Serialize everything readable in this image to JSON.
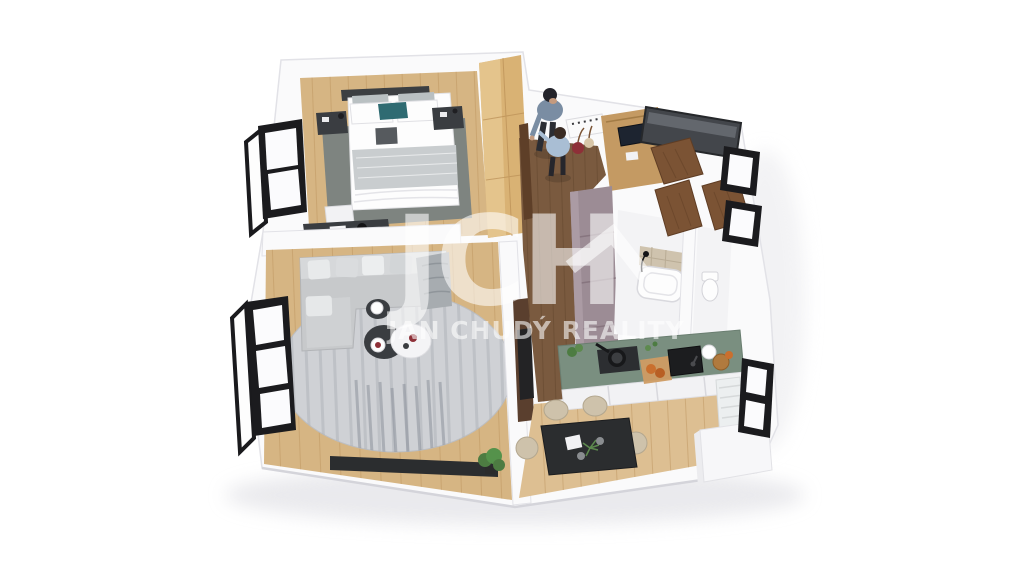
{
  "watermark": {
    "logo": "JCH",
    "roof_icon": "roof-caret",
    "subtitle": "JAN CHUDÝ REALITY"
  },
  "colors": {
    "wall": "#fafafb",
    "wall_edge": "#e2e2e7",
    "wood": "#d6b583",
    "wood_line": "#bd9660",
    "wood_kitchen": "#ddbf92",
    "hall_wood": "#7a5a3f",
    "hall_line": "#664a30",
    "rug_bedroom": "#7e8480",
    "rug_round": "#cfd1d5",
    "rug_stripe": "#a9adb3",
    "sofa": "#c7c9cb",
    "counter_green": "#7a8f80",
    "cabinet_mauve": "#9c8c95",
    "door_brown": "#7b5334",
    "window_black": "#1b1b1e",
    "dark_furniture": "#3a3d41",
    "black_furniture": "#2b2d2f",
    "chair_beige": "#cec2ab",
    "accent_teal": "#2f6b72",
    "plant_green": "#4d7c42",
    "person_shirt": "#7a8da3",
    "child_shirt": "#a9bed4",
    "red_accent": "#8e3038",
    "wardrobe_wood": "#d9b274",
    "desk_wood": "#c49a63",
    "glass_dark": "#43464b",
    "tile_beige": "#cfc3ae",
    "white": "#fdfdfd",
    "background": "#ffffff"
  }
}
